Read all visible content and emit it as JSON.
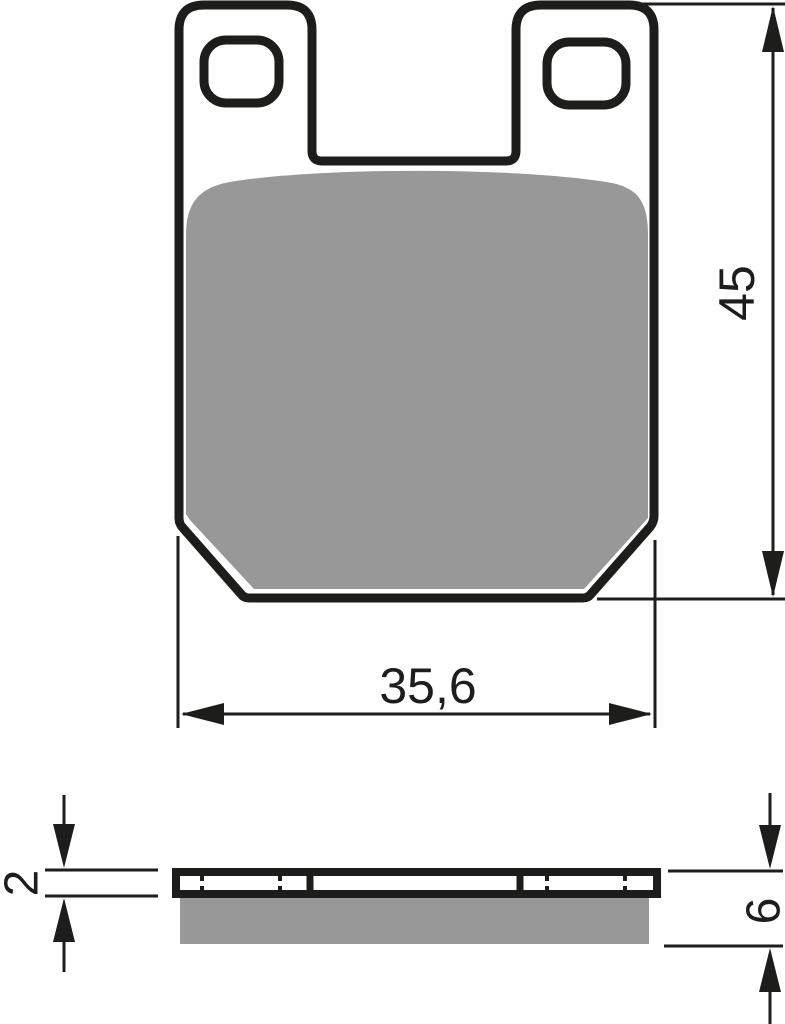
{
  "drawing": {
    "colors": {
      "outline": "#1d1d1b",
      "friction_material": "#989898",
      "background": "#ffffff"
    },
    "front_view": {
      "height_dimension_label": "45",
      "width_dimension_label": "35,6"
    },
    "side_view": {
      "backplate_thickness_label": "2",
      "pad_thickness_label": "6"
    }
  }
}
